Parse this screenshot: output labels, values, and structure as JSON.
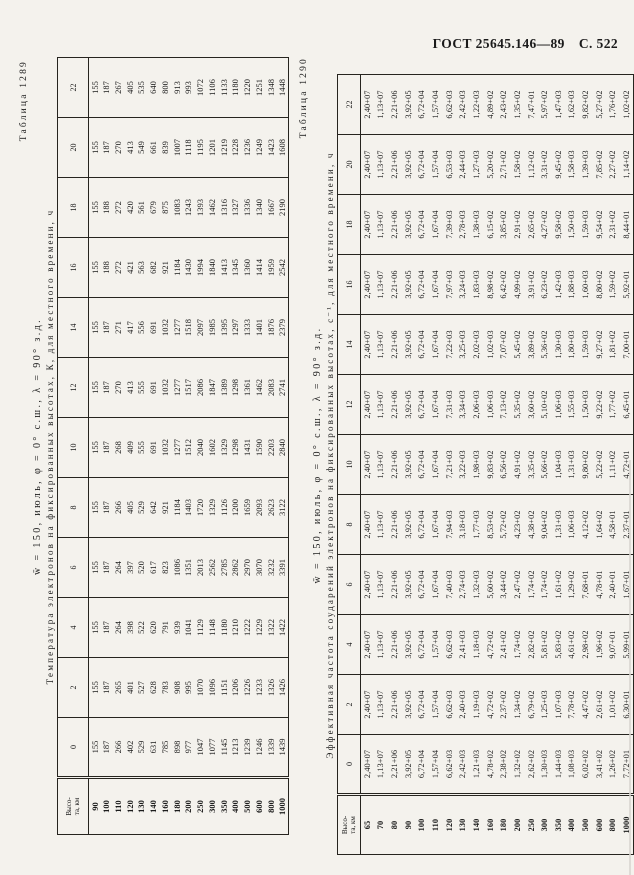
{
  "page_header": {
    "standard": "ГОСТ 25645.146—89",
    "page": "С. 522"
  },
  "tables": [
    {
      "label": "Таблица 1289",
      "title": "w̄ = 150, июль, φ = 0° с.ш., λ = 90° з.д.",
      "subtitle": "Температура электронов на фиксированных высотах, К, для местного времени, ч",
      "corner_header": [
        "Высо-",
        "та, км"
      ],
      "hours": [
        "0",
        "2",
        "4",
        "6",
        "8",
        "10",
        "12",
        "14",
        "16",
        "18",
        "20",
        "22"
      ],
      "altitudes": [
        "90",
        "100",
        "110",
        "120",
        "130",
        "140",
        "160",
        "180",
        "200",
        "250",
        "300",
        "350",
        "400",
        "500",
        "600",
        "800",
        "1000"
      ],
      "series": [
        {
          "hour": "0",
          "values": [
            "155",
            "187",
            "266",
            "402",
            "529",
            "631",
            "785",
            "898",
            "977",
            "1047",
            "1077",
            "1145",
            "1213",
            "1239",
            "1246",
            "1339",
            "1439"
          ]
        },
        {
          "hour": "2",
          "values": [
            "155",
            "187",
            "265",
            "401",
            "527",
            "628",
            "783",
            "908",
            "995",
            "1070",
            "1096",
            "1151",
            "1206",
            "1226",
            "1233",
            "1326",
            "1426"
          ]
        },
        {
          "hour": "4",
          "values": [
            "155",
            "187",
            "264",
            "398",
            "522",
            "620",
            "791",
            "939",
            "1041",
            "1129",
            "1148",
            "1180",
            "1210",
            "1222",
            "1229",
            "1322",
            "1422"
          ]
        },
        {
          "hour": "6",
          "values": [
            "155",
            "187",
            "264",
            "397",
            "520",
            "617",
            "823",
            "1086",
            "1351",
            "2013",
            "2562",
            "2785",
            "2862",
            "2970",
            "3070",
            "3232",
            "3391"
          ]
        },
        {
          "hour": "8",
          "values": [
            "155",
            "187",
            "266",
            "405",
            "529",
            "642",
            "921",
            "1184",
            "1403",
            "1720",
            "1329",
            "1126",
            "1200",
            "1659",
            "2093",
            "2623",
            "3122"
          ]
        },
        {
          "hour": "10",
          "values": [
            "155",
            "187",
            "268",
            "409",
            "555",
            "691",
            "1032",
            "1277",
            "1512",
            "2040",
            "1602",
            "1329",
            "1298",
            "1431",
            "1590",
            "2203",
            "2840"
          ]
        },
        {
          "hour": "12",
          "values": [
            "155",
            "187",
            "270",
            "413",
            "555",
            "691",
            "1032",
            "1277",
            "1517",
            "2086",
            "1847",
            "1389",
            "1298",
            "1361",
            "1462",
            "2083",
            "2741"
          ]
        },
        {
          "hour": "14",
          "values": [
            "155",
            "187",
            "271",
            "417",
            "556",
            "691",
            "1032",
            "1277",
            "1518",
            "2097",
            "1985",
            "1395",
            "1297",
            "1333",
            "1401",
            "1876",
            "2379"
          ]
        },
        {
          "hour": "16",
          "values": [
            "155",
            "188",
            "272",
            "421",
            "563",
            "682",
            "921",
            "1184",
            "1430",
            "1994",
            "1840",
            "1413",
            "1345",
            "1360",
            "1414",
            "1959",
            "2542"
          ]
        },
        {
          "hour": "18",
          "values": [
            "155",
            "188",
            "272",
            "420",
            "561",
            "679",
            "875",
            "1083",
            "1243",
            "1393",
            "1462",
            "1316",
            "1327",
            "1336",
            "1340",
            "1667",
            "2190"
          ]
        },
        {
          "hour": "20",
          "values": [
            "155",
            "187",
            "270",
            "413",
            "549",
            "661",
            "839",
            "1007",
            "1118",
            "1195",
            "1201",
            "1219",
            "1228",
            "1236",
            "1249",
            "1423",
            "1608"
          ]
        },
        {
          "hour": "22",
          "values": [
            "155",
            "187",
            "267",
            "405",
            "535",
            "640",
            "800",
            "913",
            "993",
            "1072",
            "1106",
            "1133",
            "1180",
            "1220",
            "1251",
            "1348",
            "1448"
          ]
        }
      ]
    },
    {
      "label": "Таблица 1290",
      "title": "w̄ = 150, июль, φ = 0° с.ш., λ = 90° з.д.",
      "subtitle": "Эффективная частота соударений электронов на фиксированных высотах, с⁻¹, для местного времени, ч",
      "corner_header": [
        "Высо-",
        "та, км"
      ],
      "hours": [
        "0",
        "2",
        "4",
        "6",
        "8",
        "10",
        "12",
        "14",
        "16",
        "18",
        "20",
        "22"
      ],
      "altitudes": [
        "65",
        "70",
        "80",
        "90",
        "100",
        "110",
        "120",
        "130",
        "140",
        "160",
        "180",
        "200",
        "250",
        "300",
        "350",
        "400",
        "500",
        "600",
        "800",
        "1000"
      ],
      "series": [
        {
          "hour": "0",
          "values": [
            "2,40+07",
            "1,13+07",
            "2,21+06",
            "3,92+05",
            "6,72+04",
            "1,57+04",
            "6,62+03",
            "2,42+03",
            "1,21+03",
            "4,78+02",
            "2,38+02",
            "1,32+02",
            "2,62+02",
            "1,30+03",
            "1,44+03",
            "1,08+03",
            "6,02+02",
            "3,41+02",
            "1,26+02",
            "7,72+01"
          ]
        },
        {
          "hour": "2",
          "values": [
            "2,40+07",
            "1,13+07",
            "2,21+06",
            "3,92+05",
            "6,72+04",
            "1,57+04",
            "6,62+03",
            "2,40+03",
            "1,19+03",
            "4,72+02",
            "2,37+02",
            "1,34+02",
            "6,79+02",
            "1,25+03",
            "1,07+03",
            "7,78+02",
            "4,47+02",
            "2,61+02",
            "1,01+02",
            "6,30+01"
          ]
        },
        {
          "hour": "4",
          "values": [
            "2,40+07",
            "1,13+07",
            "2,21+06",
            "3,92+05",
            "6,72+04",
            "1,57+04",
            "6,62+03",
            "2,41+03",
            "1,18+03",
            "4,72+02",
            "2,41+02",
            "1,74+02",
            "2,82+02",
            "5,81+02",
            "5,83+02",
            "4,61+02",
            "2,98+02",
            "1,96+02",
            "9,07+01",
            "5,99+01"
          ]
        },
        {
          "hour": "6",
          "values": [
            "2,40+07",
            "1,13+07",
            "2,21+06",
            "3,92+05",
            "6,72+04",
            "1,67+04",
            "7,40+03",
            "2,74+03",
            "1,32+03",
            "5,60+02",
            "3,44+02",
            "2,47+02",
            "1,74+02",
            "1,74+02",
            "1,61+02",
            "1,29+02",
            "7,68+01",
            "4,78+01",
            "2,40+01",
            "1,67+01"
          ]
        },
        {
          "hour": "8",
          "values": [
            "2,40+07",
            "1,13+07",
            "2,21+06",
            "3,92+05",
            "6,72+04",
            "1,67+04",
            "7,94+03",
            "3,18+03",
            "1,77+03",
            "8,53+02",
            "5,72+02",
            "4,23+02",
            "4,38+02",
            "9,04+02",
            "1,31+03",
            "1,06+03",
            "4,12+02",
            "1,64+02",
            "4,58+01",
            "2,37+01"
          ]
        },
        {
          "hour": "10",
          "values": [
            "2,40+07",
            "1,13+07",
            "2,21+06",
            "3,92+05",
            "6,72+04",
            "1,67+04",
            "7,21+03",
            "3,22+03",
            "1,98+03",
            "9,83+02",
            "6,56+02",
            "4,91+02",
            "3,35+02",
            "5,66+02",
            "1,04+03",
            "1,31+03",
            "9,80+02",
            "5,22+02",
            "1,11+02",
            "4,72+01"
          ]
        },
        {
          "hour": "12",
          "values": [
            "2,40+07",
            "1,13+07",
            "2,21+06",
            "3,92+05",
            "6,72+04",
            "1,67+04",
            "7,31+03",
            "3,34+03",
            "2,06+03",
            "1,06+03",
            "7,13+02",
            "5,35+02",
            "3,60+02",
            "5,10+02",
            "1,06+03",
            "1,55+03",
            "1,50+03",
            "9,22+02",
            "1,77+02",
            "6,45+01"
          ]
        },
        {
          "hour": "14",
          "values": [
            "2,40+07",
            "1,13+07",
            "2,21+06",
            "3,92+05",
            "6,72+04",
            "1,67+04",
            "7,22+03",
            "3,25+03",
            "2,02+03",
            "1,02+03",
            "7,07+02",
            "5,45+02",
            "3,89+02",
            "5,36+02",
            "1,30+03",
            "1,80+03",
            "1,59+03",
            "9,27+02",
            "1,81+02",
            "7,00+01"
          ]
        },
        {
          "hour": "16",
          "values": [
            "2,40+07",
            "1,13+07",
            "2,21+06",
            "3,92+05",
            "6,72+04",
            "1,67+04",
            "7,97+03",
            "3,24+03",
            "1,83+03",
            "8,98+02",
            "6,42+02",
            "4,99+02",
            "3,91+02",
            "6,23+02",
            "1,42+03",
            "1,88+03",
            "1,60+03",
            "8,80+02",
            "1,59+02",
            "5,92+01"
          ]
        },
        {
          "hour": "18",
          "values": [
            "2,40+07",
            "1,13+07",
            "2,21+06",
            "3,92+05",
            "6,72+04",
            "1,67+04",
            "7,39+03",
            "2,78+03",
            "1,38+03",
            "6,15+02",
            "3,85+02",
            "2,91+02",
            "2,65+02",
            "4,27+02",
            "9,58+02",
            "1,50+03",
            "1,59+03",
            "9,54+02",
            "2,31+02",
            "8,44+01"
          ]
        },
        {
          "hour": "20",
          "values": [
            "2,40+07",
            "1,13+07",
            "2,21+06",
            "3,92+05",
            "6,72+04",
            "1,57+04",
            "6,53+03",
            "2,44+03",
            "1,27+03",
            "5,20+02",
            "2,71+02",
            "1,58+02",
            "1,12+02",
            "3,31+02",
            "9,45+02",
            "1,58+03",
            "1,39+03",
            "7,85+02",
            "2,27+02",
            "1,14+02"
          ]
        },
        {
          "hour": "22",
          "values": [
            "2,40+07",
            "1,13+07",
            "2,21+06",
            "3,92+05",
            "6,72+04",
            "1,57+04",
            "6,62+03",
            "2,42+03",
            "1,22+03",
            "4,89+02",
            "2,43+02",
            "1,35+02",
            "7,47+01",
            "5,97+02",
            "1,47+03",
            "1,62+03",
            "9,82+02",
            "5,27+02",
            "1,76+02",
            "1,02+02"
          ]
        }
      ]
    }
  ]
}
